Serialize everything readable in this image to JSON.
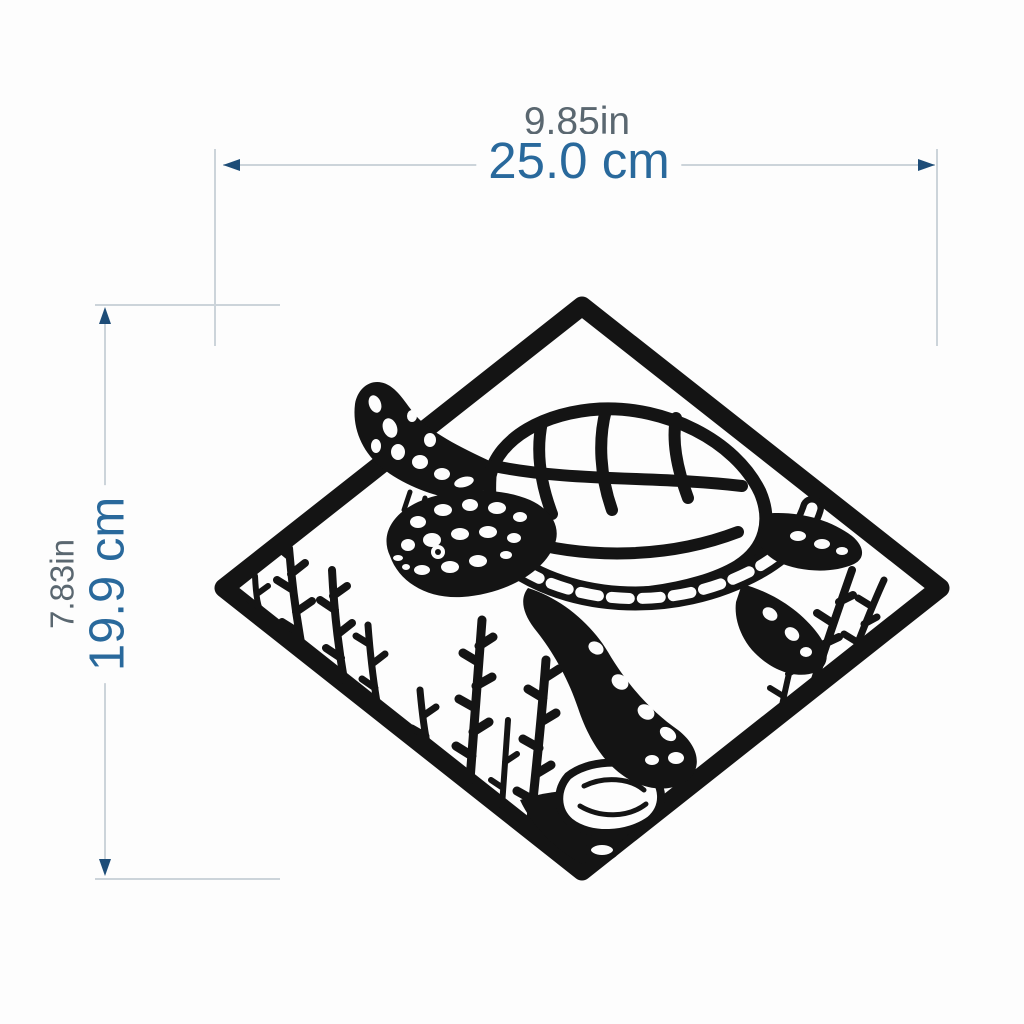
{
  "colors": {
    "bg": "#fdfdfd",
    "art": "#141414",
    "accent": "#29699c",
    "muted": "#5a6770",
    "line": "#ccd4da",
    "arrow": "#1e4d78"
  },
  "width_dimension": {
    "inches": "9.85in",
    "centimeters": "25.0 cm"
  },
  "height_dimension": {
    "inches": "7.83in",
    "centimeters": "19.9 cm"
  },
  "artwork": {
    "subject": "sea-turtle-diamond-wall-art",
    "elements": [
      "diamond-frame",
      "sea-turtle",
      "seaweed",
      "rocks"
    ]
  }
}
